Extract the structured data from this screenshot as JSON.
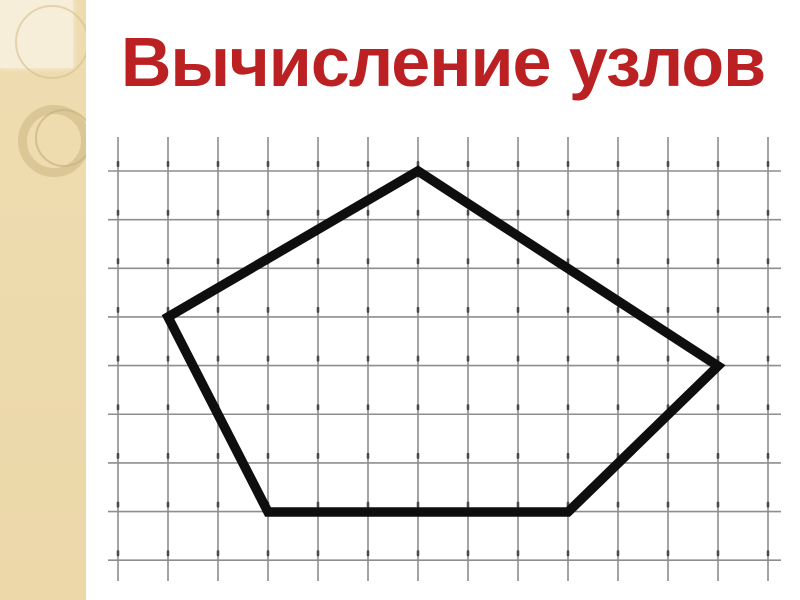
{
  "slide": {
    "title": "Вычисление узлов"
  },
  "colors": {
    "background": "#ffffff",
    "sidebar": "#eedcb0",
    "sidebar_bottom": "#ecd8a9",
    "sidebar_light": "#f6eed8",
    "title": "#bb2023",
    "grid_line": "#8e8e8e",
    "grid_node": "#3a3a3a",
    "pentagon": "#0e0e0e"
  },
  "grid": {
    "columns": 14,
    "rows": 9,
    "origin_x": 118,
    "origin_y": 171,
    "spacing_x": 50,
    "spacing_y": 48.65,
    "vertical_top": 137,
    "vertical_bottom": 581,
    "horizontal_left": 108,
    "horizontal_right": 781,
    "line_width": 1.6,
    "node_dash_width": 2.6,
    "node_dash_height": 6,
    "node_dash_offset": 10
  },
  "pentagon": {
    "stroke_width": 9.5,
    "vertices_grid_units": [
      [
        6,
        0
      ],
      [
        12,
        4
      ],
      [
        9,
        7
      ],
      [
        3,
        7
      ],
      [
        1,
        3
      ]
    ],
    "vertices_px": [
      [
        418,
        171
      ],
      [
        718,
        366
      ],
      [
        568,
        512
      ],
      [
        268,
        512
      ],
      [
        168,
        317
      ]
    ]
  }
}
